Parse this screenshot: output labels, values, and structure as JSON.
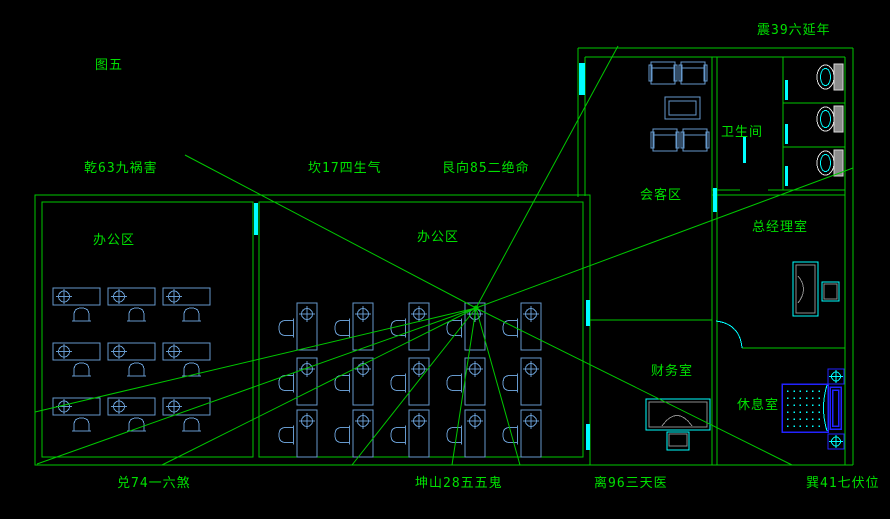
{
  "figure_label": "图五",
  "compass_labels": {
    "nw": "乾63九祸害",
    "n": "坎17四生气",
    "ne": "艮向85二绝命",
    "e": "震39六延年",
    "w": "兑74一六煞",
    "sw": "坤山28五五鬼",
    "s": "离96三天医",
    "se": "巽41七伏位"
  },
  "rooms": {
    "office_left": "办公区",
    "office_center": "办公区",
    "meeting": "会客区",
    "bathroom": "卫生间",
    "executive": "总经理室",
    "finance": "财务室",
    "rest": "休息室"
  },
  "symbols": {
    "workstation-icon": "desk with computer crosshair and chair",
    "toilet-icon": "toilet bowl with tank",
    "sofa-icon": "armchair sofa",
    "coffee-table-icon": "nested rectangle table",
    "executive-desk-icon": "desk with arc cutout and chair",
    "finance-desk-icon": "desk with arc cutout and chair",
    "bed-icon": "dotted mattress with pillow",
    "survey-point-icon": "boxed crosshair marker",
    "door-icon": "cyan door leaf / swing arc",
    "window-icon": "cyan wall bar"
  },
  "colors": {
    "background": "#000000",
    "wall": "#00c800",
    "text": "#00e000",
    "furniture": "#6699cc",
    "accent": "#00ffff",
    "fixture_blue": "#2222ff",
    "fixture_gray": "#8c8c8c",
    "fixture_white": "#d9d9d9"
  }
}
